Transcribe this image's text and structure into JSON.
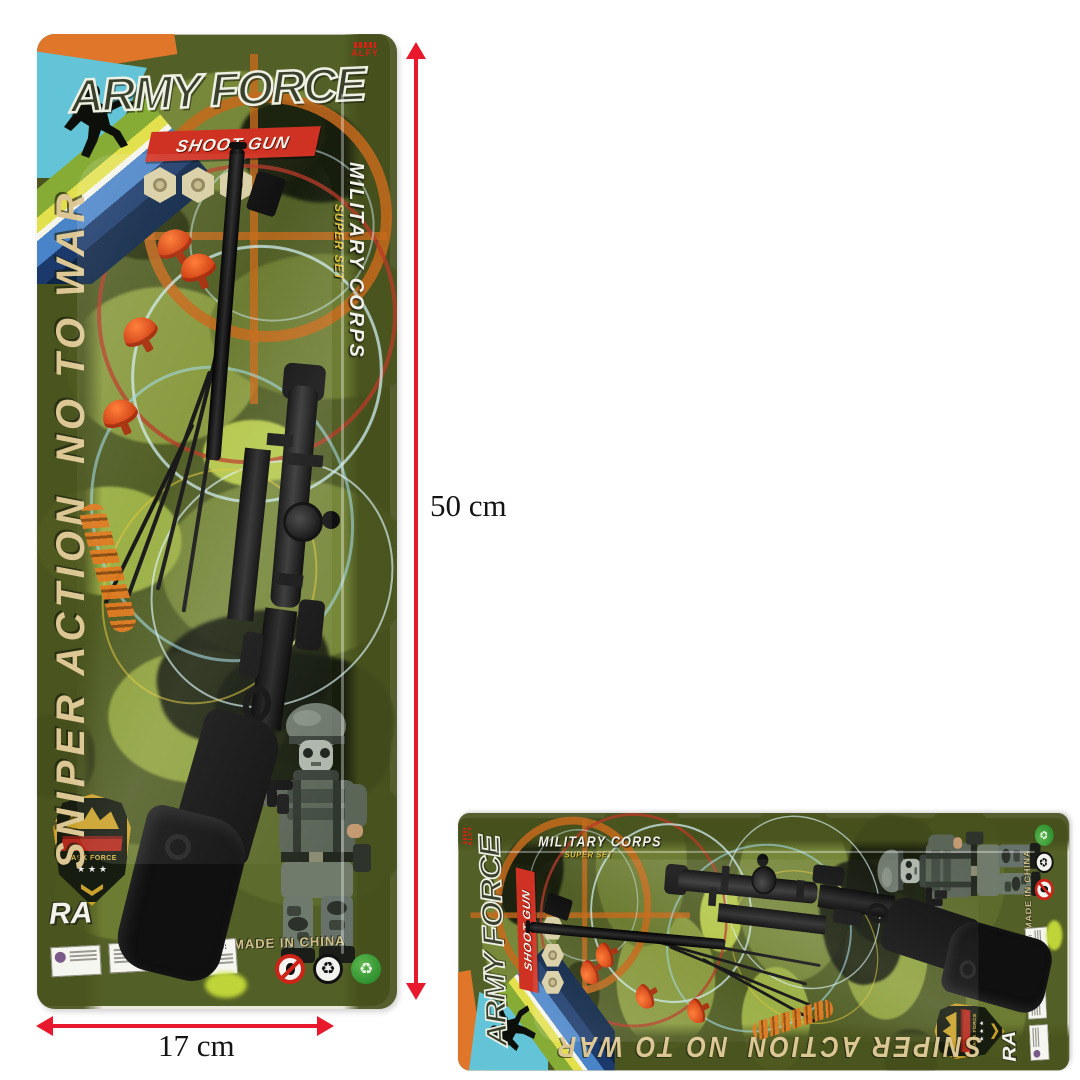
{
  "scene": {
    "dimension_height_label": "50 cm",
    "dimension_width_label": "17 cm"
  },
  "package": {
    "brand_mark": "ALFY",
    "title": "ARMY FORCE",
    "banner": "SHOOT GUN",
    "side_left_upper": "NO TO WAR",
    "side_left_lower": "SNIPER ACTION",
    "side_right_title": "MILITARY CORPS",
    "side_right_subtitle": "SUPER SET",
    "partial_word_1": "NG",
    "partial_word_2": "TO",
    "partial_word_3": "RA",
    "badge_text": "TASK FORCE",
    "badge_stars": "★ ★ ★",
    "warning_title": "WARNING:",
    "made_in": "MADE IN CHINA",
    "recycle_glyph": "♻"
  },
  "colors": {
    "arrow-red": "#e8192c",
    "card-olive": "#525f26",
    "banner-red": "#cf3222",
    "khaki-text": "#dcc794",
    "yellow-sub": "#e2c23a",
    "white-text": "#f2f2ea"
  }
}
